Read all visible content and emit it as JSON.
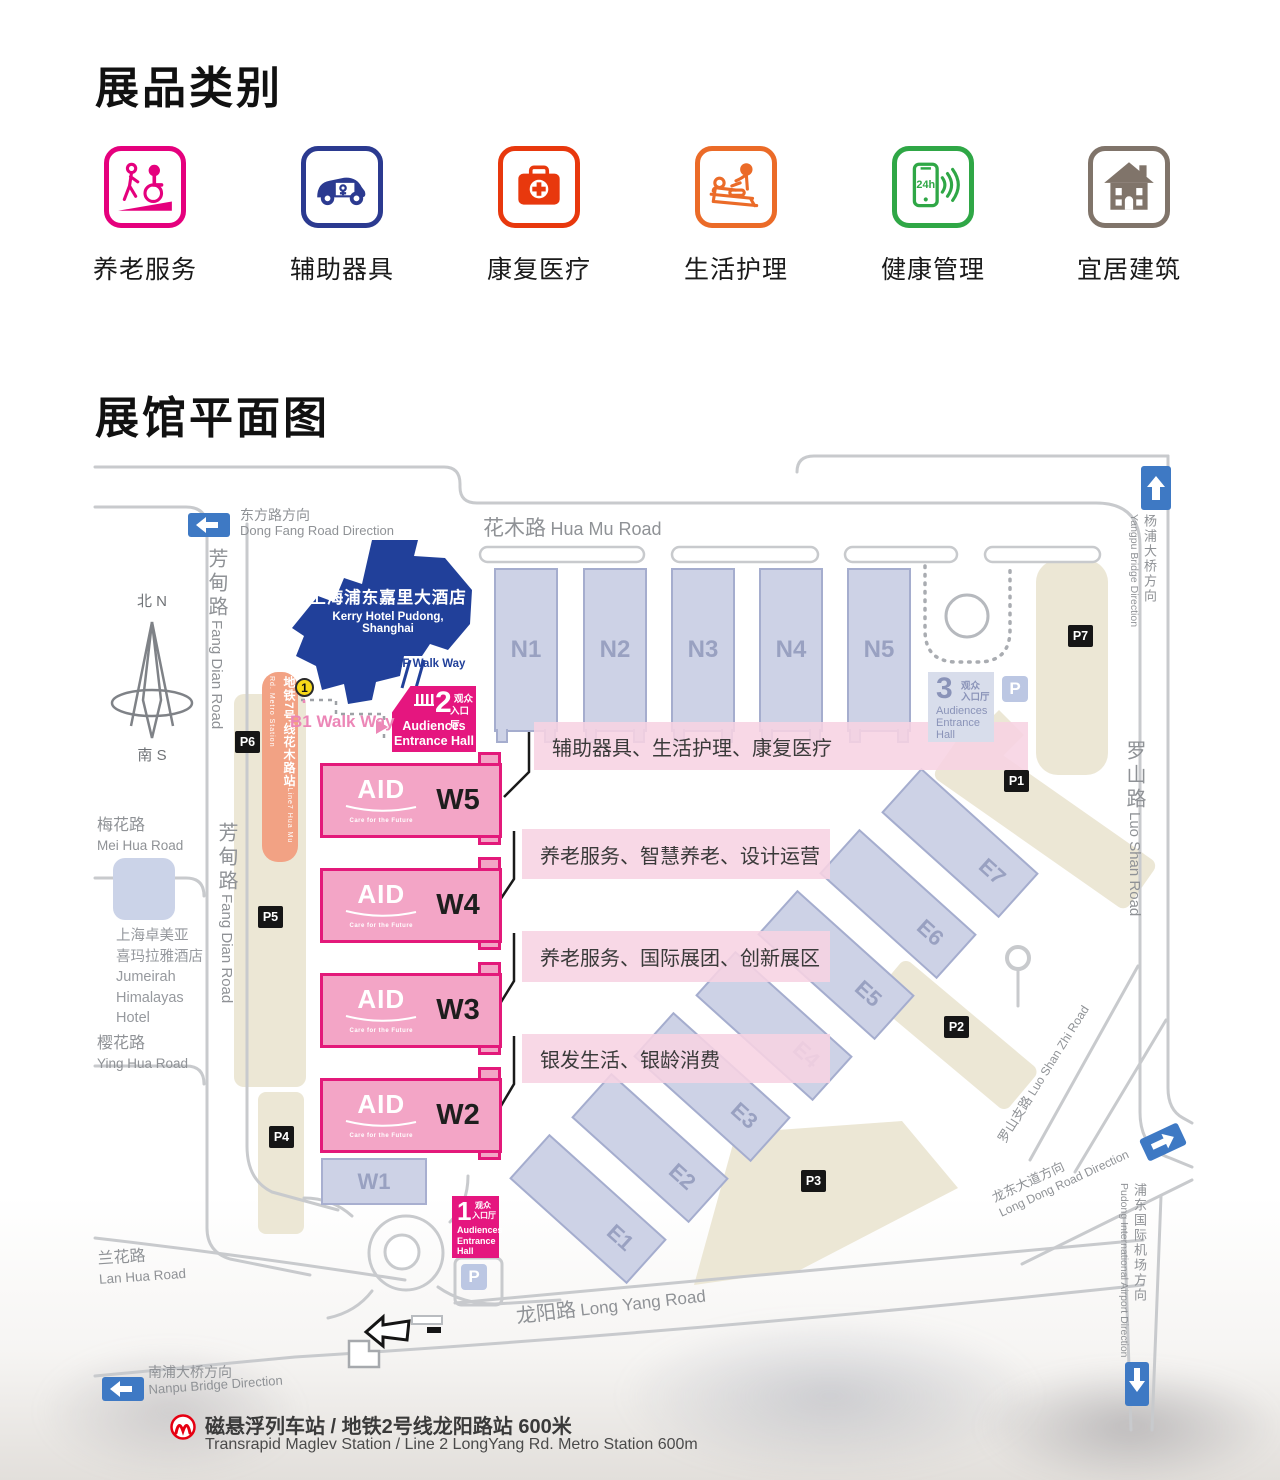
{
  "categories": {
    "title": "展品类别",
    "items": [
      {
        "label": "养老服务",
        "color": "#E5007D",
        "icon": "wheelchair-ramp-icon"
      },
      {
        "label": "辅助器具",
        "color": "#2B3A90",
        "icon": "accessible-van-icon"
      },
      {
        "label": "康复医疗",
        "color": "#E8380D",
        "icon": "first-aid-kit-icon"
      },
      {
        "label": "生活护理",
        "color": "#EB6B28",
        "icon": "care-bed-icon"
      },
      {
        "label": "健康管理",
        "color": "#2FA746",
        "icon": "phone-24h-icon"
      },
      {
        "label": "宜居建筑",
        "color": "#80746A",
        "icon": "house-icon"
      }
    ]
  },
  "floorplan": {
    "title": "展馆平面图",
    "compass": {
      "north": "北 N",
      "south": "南 S"
    },
    "roads": {
      "hua_mu_zh": "花木路",
      "hua_mu_en": "Hua Mu Road",
      "fang_dian_zh": "芳甸路",
      "fang_dian_en": "Fang Dian Road",
      "mei_hua_zh": "梅花路",
      "mei_hua_en": "Mei Hua Road",
      "ying_hua_zh": "樱花路",
      "ying_hua_en": "Ying Hua Road",
      "lan_hua_zh": "兰花路",
      "lan_hua_en": "Lan Hua Road",
      "long_yang_zh": "龙阳路",
      "long_yang_en": "Long Yang Road",
      "luo_shan_zh": "罗山路",
      "luo_shan_en": "Luo Shan Road",
      "luo_shan_zhi_zh": "罗山支路",
      "luo_shan_zhi_en": "Luo Shan Zhi Road"
    },
    "directions": {
      "dong_fang_zh": "东方路方向",
      "dong_fang_en": "Dong Fang Road Direction",
      "nanpu_zh": "南浦大桥方向",
      "nanpu_en": "Nanpu Bridge Direction",
      "yangpu_zh": "杨浦大桥方向",
      "yangpu_en": "Yangpu Bridge Direction",
      "long_dong_zh": "龙东大道方向",
      "long_dong_en": "Long Dong Road Direction",
      "airport_zh": "浦东国际机场方向",
      "airport_en": "Pudong International Airport Direction"
    },
    "landmarks": {
      "kerry_zh": "上海浦东嘉里大酒店",
      "kerry_en": "Kerry Hotel Pudong, Shanghai",
      "jumeirah_zh1": "上海卓美亚",
      "jumeirah_zh2": "喜玛拉雅酒店",
      "jumeirah_en1": "Jumeirah",
      "jumeirah_en2": "Himalayas",
      "jumeirah_en3": "Hotel",
      "metro7_zh": "地铁7号线花木路站",
      "metro7_en": "Line7 Hua Mu Rd. Metro Station",
      "metro7_no": "1",
      "walkway_2f": "2F Walk Way",
      "walkway_b1": "B1 Walk Way"
    },
    "entrances": {
      "e1_no": "1",
      "e2_no": "2",
      "e3_no": "3",
      "zh1": "观众",
      "zh2": "入口厅",
      "en1": "Audiences",
      "en2": "Entrance",
      "en3": "Hall",
      "en_line2": "Entrance Hall"
    },
    "parking_letter": "P",
    "badges": {
      "p1": "P1",
      "p2": "P2",
      "p3": "P3",
      "p4": "P4",
      "p5": "P5",
      "p6": "P6",
      "p7": "P7"
    },
    "halls": {
      "north": [
        "N1",
        "N2",
        "N3",
        "N4",
        "N5"
      ],
      "west": [
        "W5",
        "W4",
        "W3",
        "W2"
      ],
      "w1": "W1",
      "east": [
        "E1",
        "E2",
        "E3",
        "E4",
        "E5",
        "E6",
        "E7"
      ]
    },
    "aid": {
      "text": "AID",
      "tagline": "Care for the Future"
    },
    "callouts": [
      "辅助器具、生活护理、康复医疗",
      "养老服务、智慧养老、设计运营",
      "养老服务、国际展团、创新展区",
      "银发生活、银龄消费"
    ],
    "footnote": {
      "zh": "磁悬浮列车站 / 地铁2号线龙阳路站 600米",
      "en": "Transrapid Maglev Station / Line 2 LongYang Rd. Metro Station   600m"
    }
  }
}
